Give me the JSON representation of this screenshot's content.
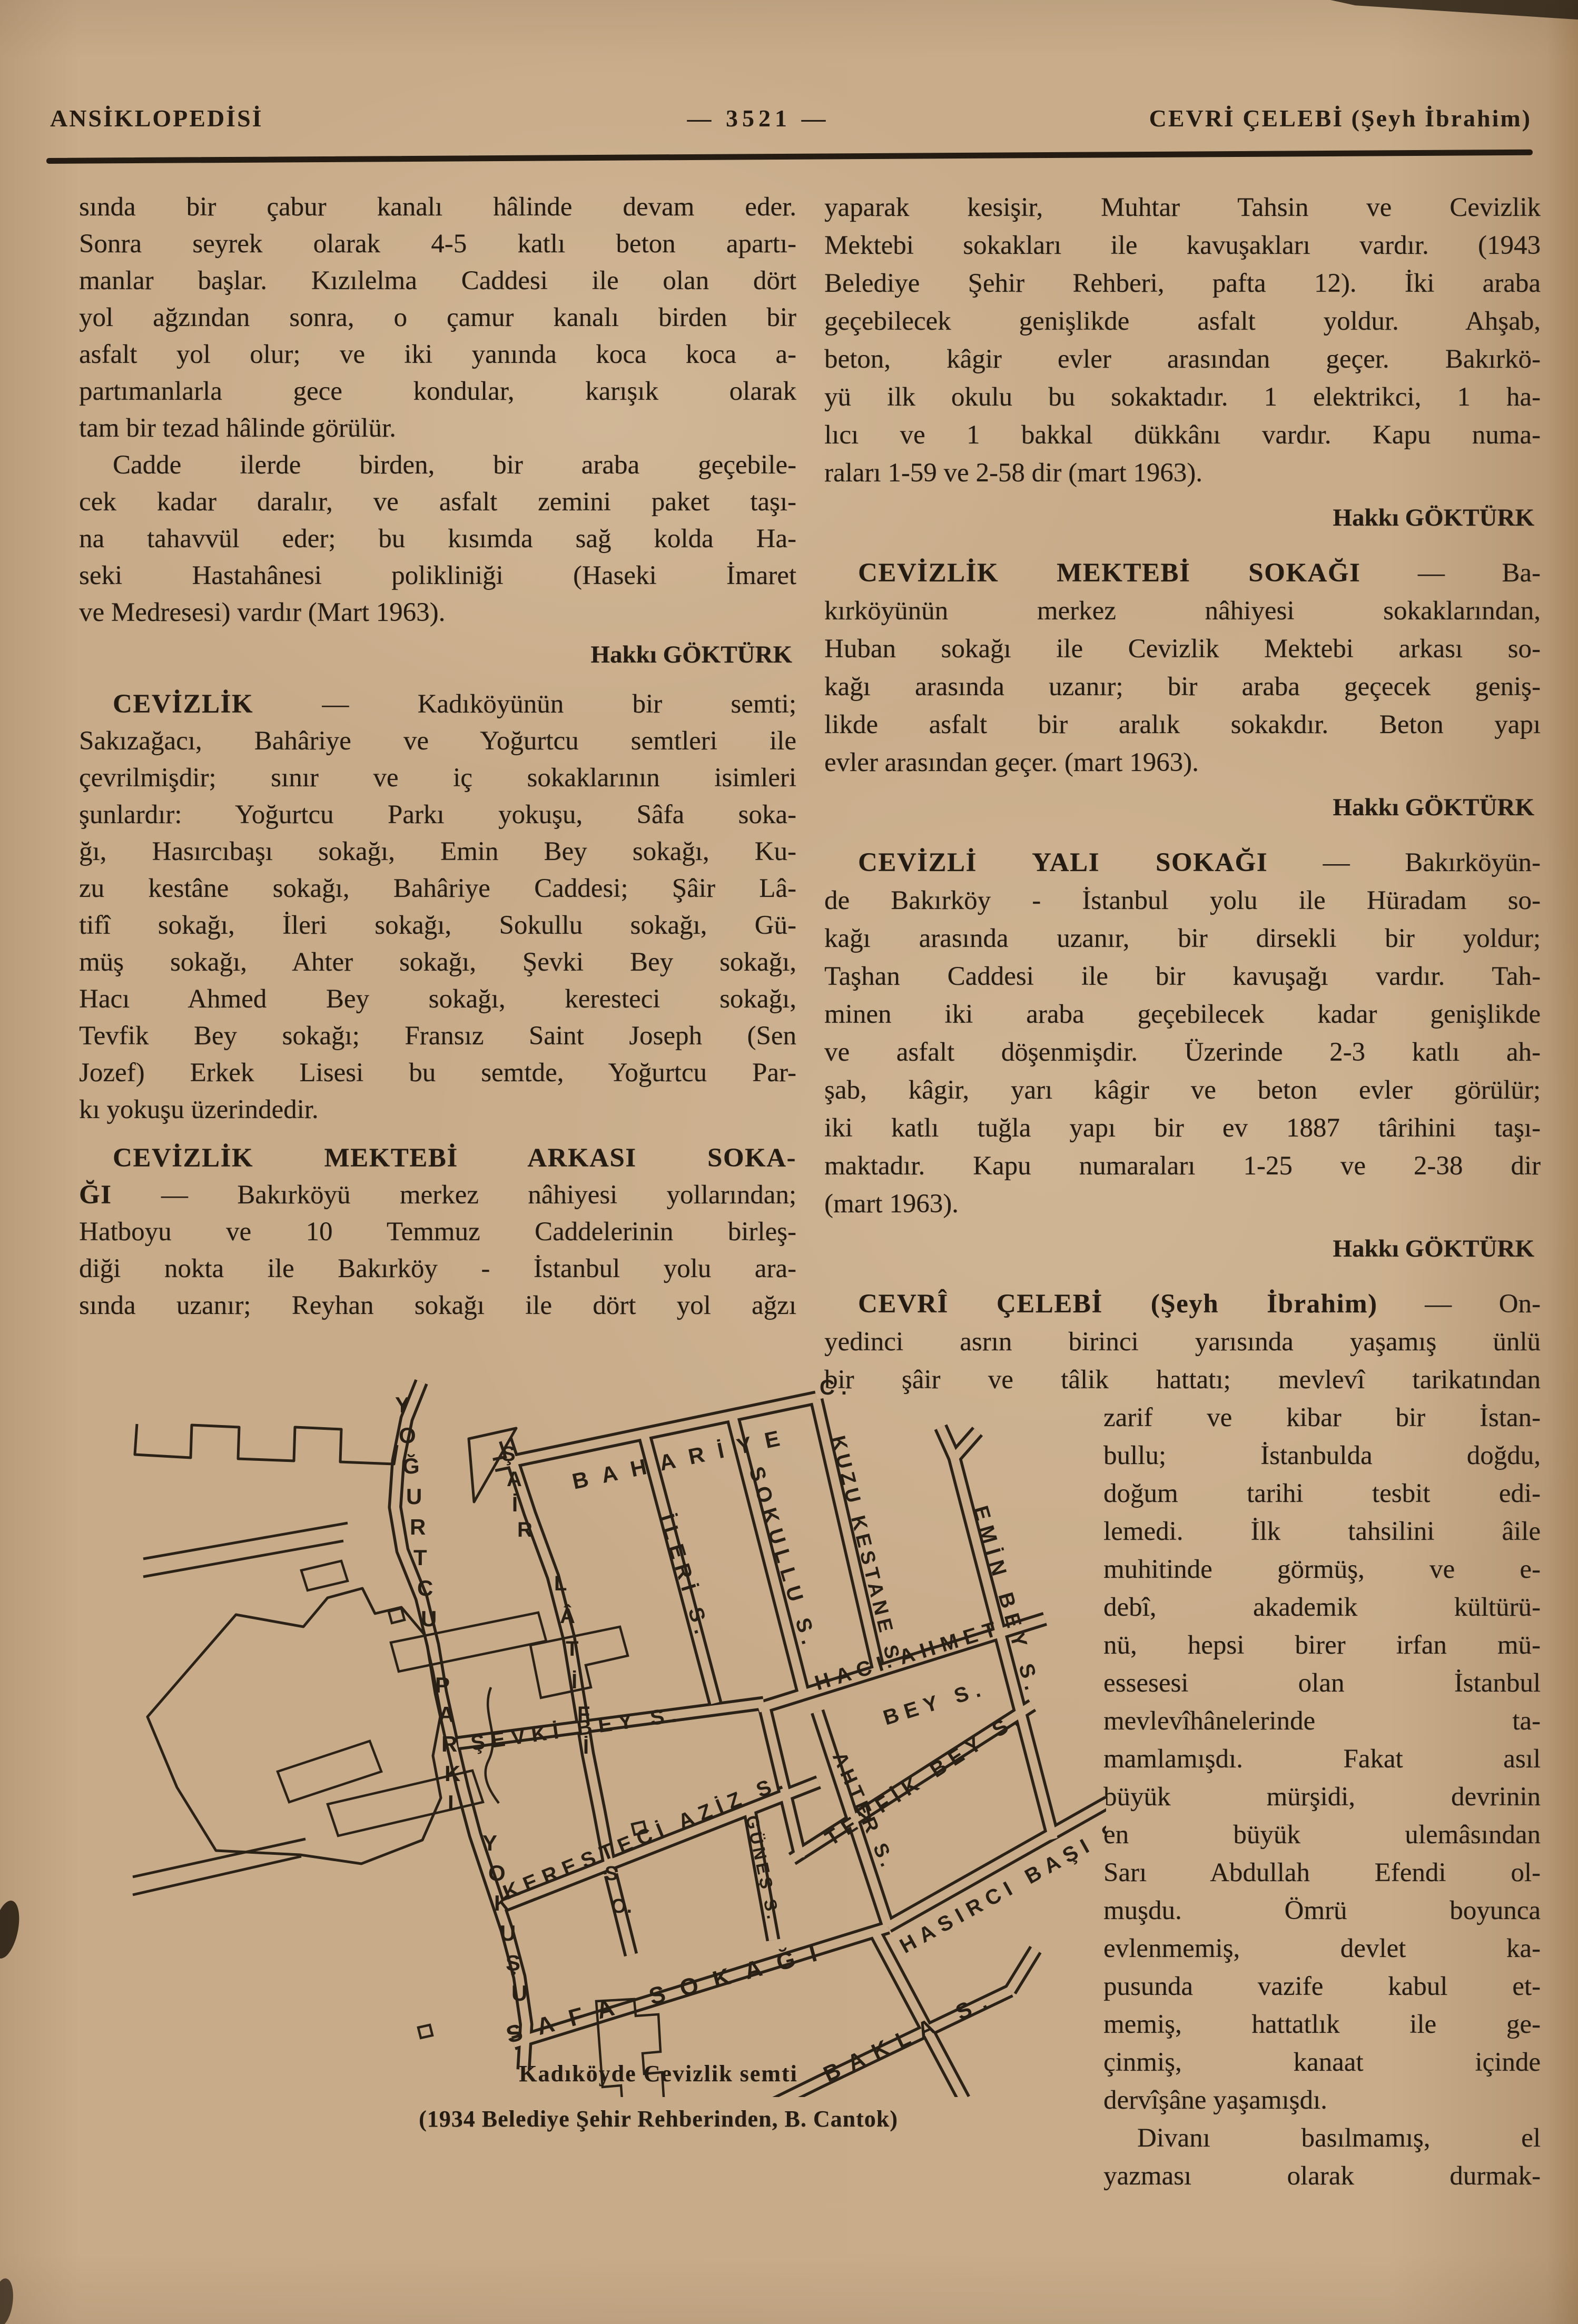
{
  "header": {
    "left": "ANSİKLOPEDİSİ",
    "center": "— 3521 —",
    "right": "CEVRİ ÇELEBİ (Şeyh İbrahim)"
  },
  "columns": {
    "left": [
      {
        "type": "p",
        "lines": [
          "sında bir çabur kanalı hâlinde devam eder.",
          "Sonra seyrek olarak 4-5 katlı beton apartı-",
          "manlar başlar. Kızılelma Caddesi ile olan dört",
          "yol ağzından sonra, o çamur kanalı birden bir",
          "asfalt yol olur; ve iki yanında koca koca a-",
          "partımanlarla gece kondular, karışık olarak",
          "tam bir tezad hâlinde görülür."
        ]
      },
      {
        "type": "p",
        "indent": true,
        "lines": [
          "Cadde ilerde birden, bir araba geçebile-",
          "cek kadar daralır, ve asfalt zemini paket taşı-",
          "na tahavvül eder; bu kısımda sağ kolda Ha-",
          "seki Hastahânesi polikliniği (Haseki İmaret",
          "ve Medresesi) vardır (Mart 1963)."
        ]
      },
      {
        "type": "sig",
        "text": "Hakkı GÖKTÜRK"
      },
      {
        "type": "p",
        "indent": true,
        "entry": true,
        "lines": [
          {
            "b": "CEVİZLİK",
            "t": " — Kadıköyünün bir semti;"
          },
          "Sakızağacı, Bahâriye ve Yoğurtcu semtleri ile",
          "çevrilmişdir; sınır ve iç sokaklarının isimleri",
          "şunlardır: Yoğurtcu Parkı yokuşu, Sâfa soka-",
          "ğı, Hasırcıbaşı sokağı, Emin Bey sokağı, Ku-",
          "zu kestâne sokağı, Bahâriye Caddesi; Şâir Lâ-",
          "tifî sokağı, İleri sokağı, Sokullu sokağı, Gü-",
          "müş sokağı, Ahter sokağı, Şevki Bey sokağı,",
          "Hacı Ahmed Bey sokağı, keresteci sokağı,",
          "Tevfik Bey sokağı; Fransız Saint Joseph (Sen",
          "Jozef) Erkek Lisesi bu semtde, Yoğurtcu Par-",
          "kı yokuşu üzerindedir."
        ]
      },
      {
        "type": "p",
        "indent": true,
        "entry": true,
        "cont": true,
        "lines": [
          {
            "b": "CEVİZLİK MEKTEBİ ARKASI SOKA-"
          },
          {
            "b": "ĞI",
            "t": " — Bakırköyü merkez nâhiyesi yollarından;"
          },
          "Hatboyu ve 10 Temmuz Caddelerinin birleş-",
          "diği nokta ile Bakırköy - İstanbul yolu ara-",
          "sında uzanır; Reyhan sokağı ile dört yol ağzı"
        ]
      }
    ],
    "right": [
      {
        "type": "p",
        "lines": [
          "yaparak kesişir, Muhtar Tahsin ve Cevizlik",
          "Mektebi sokakları ile kavuşakları vardır. (1943",
          "Belediye Şehir Rehberi, pafta 12). İki araba",
          "geçebilecek genişlikde asfalt yoldur. Ahşab,",
          "beton, kâgir evler arasından geçer. Bakırkö-",
          "yü ilk okulu bu sokaktadır. 1 elektrikci, 1 ha-",
          "lıcı ve 1 bakkal dükkânı vardır. Kapu numa-",
          "raları 1-59 ve 2-58 dir (mart 1963)."
        ]
      },
      {
        "type": "sig",
        "text": "Hakkı GÖKTÜRK"
      },
      {
        "type": "p",
        "indent": true,
        "entry": true,
        "lines": [
          {
            "b": "CEVİZLİK MEKTEBİ SOKAĞI",
            "t": " — Ba-"
          },
          "kırköyünün merkez nâhiyesi sokaklarından,",
          "Huban sokağı ile Cevizlik Mektebi arkası so-",
          "kağı arasında uzanır; bir araba geçecek geniş-",
          "likde asfalt bir aralık sokakdır. Beton yapı",
          "evler arasından geçer. (mart 1963)."
        ]
      },
      {
        "type": "sig",
        "text": "Hakkı GÖKTÜRK"
      },
      {
        "type": "p",
        "indent": true,
        "entry": true,
        "lines": [
          {
            "b": "CEVİZLİ YALI SOKAĞI",
            "t": " — Bakırköyün-"
          },
          "de Bakırköy - İstanbul yolu ile Hüradam so-",
          "kağı arasında uzanır, bir dirsekli bir yoldur;",
          "Taşhan Caddesi ile bir kavuşağı vardır. Tah-",
          "minen iki araba geçebilecek kadar genişlikde",
          "ve asfalt döşenmişdir. Üzerinde 2-3 katlı ah-",
          "şab, kâgir, yarı kâgir ve beton evler görülür;",
          "iki katlı tuğla yapı bir ev 1887 târihini taşı-",
          "maktadır. Kapu numaraları 1-25 ve 2-38 dir",
          "(mart 1963)."
        ]
      },
      {
        "type": "sig",
        "text": "Hakkı GÖKTÜRK"
      },
      {
        "type": "p",
        "indent": true,
        "entry": true,
        "cont": true,
        "lines": [
          {
            "b": "CEVRÎ ÇELEBİ (Şeyh İbrahim)",
            "t": " — On-"
          },
          "yedinci asrın birinci yarısında yaşamış ünlü",
          "bir şâir ve tâlik hattatı; mevlevî tarikatından"
        ]
      },
      {
        "type": "p",
        "narrow": true,
        "lines": [
          "zarif ve kibar bir İstan-",
          "bullu; İstanbulda doğdu,",
          "doğum tarihi tesbit edi-",
          "lemedi. İlk tahsilini âile",
          "muhitinde görmüş, ve e-",
          "debî, akademik kültürü-",
          "nü, hepsi birer irfan mü-",
          "essesesi olan İstanbul",
          "mevlevîhânelerinde ta-",
          "mamlamışdı. Fakat asıl",
          "büyük mürşidi, devrinin",
          "en büyük ulemâsından",
          "Sarı Abdullah Efendi ol-",
          "muşdu. Ömrü boyunca",
          "evlenmemiş, devlet ka-",
          "pusunda vazife kabul et-",
          "memiş, hattatlık ile ge-",
          "çinmiş, kanaat içinde",
          "dervîşâne yaşamışdı."
        ]
      },
      {
        "type": "p",
        "narrow": true,
        "indent": true,
        "cont": true,
        "lines": [
          "Divanı basılmamış, el",
          "yazması olarak durmak-"
        ]
      }
    ]
  },
  "map": {
    "labels": {
      "yogurtcu": "YOĞURTCU",
      "parki": "PARKI",
      "yokusu": "YOKUŞU",
      "sair": "ŞAİR",
      "latifi": "LÂTİFİ",
      "so": [
        "S",
        "O."
      ],
      "bahariye": "BAHARİYE",
      "bahariye_c": "C.",
      "ileri": "İLERİ S.",
      "sokullu": "SOKULLU S.",
      "kuzu_kestane": "KUZU KESTANE S.",
      "emin_bey": "EMİN BEY S.",
      "haci_ahmet_1": "HACI AHMET",
      "haci_ahmet_2": "BEY S.",
      "sevki_bey": "ŞEVKİ BEY S.",
      "tevfik_bey": "TEVFİK BEY S.",
      "ahter": "AHTER S.",
      "gunes": "GÜNEŞ S.",
      "hasirci_basi": "HASIRCI BAŞI S.",
      "keresteci_aziz": "KERESTECİ AZİZ S.",
      "safa": "SAFA SOKAĞI",
      "bakla": "BAKLA S."
    }
  },
  "caption": {
    "line1": "Kadıköyde Cevizlik semti",
    "line2": "(1934 Belediye Şehir Rehberinden, B. Cantok)"
  }
}
